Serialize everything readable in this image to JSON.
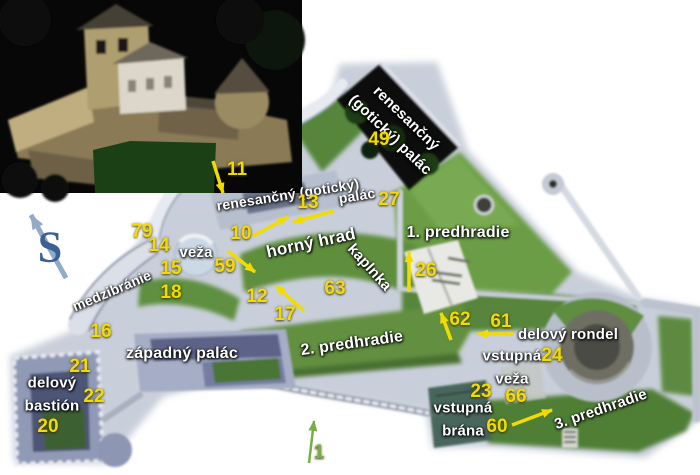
{
  "compass": {
    "letter": "S"
  },
  "colors": {
    "place_label": "#ffffff",
    "number_yellow": "#f2dc00",
    "number_green": "#76b043",
    "arrow_yellow": "#f2dc00",
    "arrow_green": "#76b043",
    "arrow_blue": "#92abca",
    "compass_letter": "#3a6094"
  },
  "map": {
    "place_labels": [
      {
        "text": "renesančný\n(gotický) palác",
        "x": 398,
        "y": 127,
        "rot": 44,
        "size": 15
      },
      {
        "text": "renesančný (gotický)",
        "x": 288,
        "y": 195,
        "rot": -9,
        "size": 14
      },
      {
        "text": "palác",
        "x": 357,
        "y": 196,
        "rot": -9,
        "size": 14
      },
      {
        "text": "horný hrad",
        "x": 311,
        "y": 243,
        "rot": -12,
        "size": 17
      },
      {
        "text": "veža",
        "x": 196,
        "y": 253,
        "rot": 0,
        "size": 15
      },
      {
        "text": "medzibránie",
        "x": 112,
        "y": 291,
        "rot": -23,
        "size": 14
      },
      {
        "text": "1. predhradie",
        "x": 458,
        "y": 233,
        "rot": 0,
        "size": 16
      },
      {
        "text": "kaplnka",
        "x": 369,
        "y": 268,
        "rot": 48,
        "size": 15
      },
      {
        "text": "2. predhradie",
        "x": 352,
        "y": 344,
        "rot": -8,
        "size": 16
      },
      {
        "text": "západný palác",
        "x": 182,
        "y": 354,
        "rot": 0,
        "size": 16
      },
      {
        "text": "delový\nbastión",
        "x": 52,
        "y": 395,
        "rot": 0,
        "size": 15
      },
      {
        "text": "delový rondel",
        "x": 568,
        "y": 335,
        "rot": 0,
        "size": 15
      },
      {
        "text": "vstupná\nveža",
        "x": 512,
        "y": 368,
        "rot": 0,
        "size": 15
      },
      {
        "text": "vstupná\nbrána",
        "x": 463,
        "y": 420,
        "rot": 0,
        "size": 15
      },
      {
        "text": "3. predhradie",
        "x": 601,
        "y": 410,
        "rot": -19,
        "size": 15
      }
    ],
    "numbers": [
      {
        "text": "11",
        "x": 237,
        "y": 170,
        "color": "yellow"
      },
      {
        "text": "49",
        "x": 379,
        "y": 140,
        "color": "yellow"
      },
      {
        "text": "13",
        "x": 308,
        "y": 203,
        "color": "yellow"
      },
      {
        "text": "27",
        "x": 389,
        "y": 200,
        "color": "yellow"
      },
      {
        "text": "79",
        "x": 142,
        "y": 232,
        "color": "yellow"
      },
      {
        "text": "14",
        "x": 159,
        "y": 246,
        "color": "yellow"
      },
      {
        "text": "10",
        "x": 241,
        "y": 234,
        "color": "yellow"
      },
      {
        "text": "15",
        "x": 171,
        "y": 269,
        "color": "yellow"
      },
      {
        "text": "59",
        "x": 225,
        "y": 267,
        "color": "yellow"
      },
      {
        "text": "18",
        "x": 171,
        "y": 293,
        "color": "yellow"
      },
      {
        "text": "12",
        "x": 257,
        "y": 297,
        "color": "yellow"
      },
      {
        "text": "17",
        "x": 285,
        "y": 315,
        "color": "yellow"
      },
      {
        "text": "63",
        "x": 335,
        "y": 289,
        "color": "yellow"
      },
      {
        "text": "26",
        "x": 426,
        "y": 271,
        "color": "yellow"
      },
      {
        "text": "16",
        "x": 101,
        "y": 332,
        "color": "yellow"
      },
      {
        "text": "21",
        "x": 80,
        "y": 367,
        "color": "yellow"
      },
      {
        "text": "22",
        "x": 94,
        "y": 397,
        "color": "yellow"
      },
      {
        "text": "20",
        "x": 48,
        "y": 427,
        "color": "yellow"
      },
      {
        "text": "62",
        "x": 460,
        "y": 320,
        "color": "yellow"
      },
      {
        "text": "61",
        "x": 501,
        "y": 322,
        "color": "yellow"
      },
      {
        "text": "24",
        "x": 552,
        "y": 356,
        "color": "yellow"
      },
      {
        "text": "23",
        "x": 481,
        "y": 392,
        "color": "yellow"
      },
      {
        "text": "66",
        "x": 516,
        "y": 397,
        "color": "yellow"
      },
      {
        "text": "60",
        "x": 497,
        "y": 427,
        "color": "yellow"
      },
      {
        "text": "1",
        "x": 319,
        "y": 453,
        "color": "green"
      }
    ],
    "arrows": [
      {
        "x1": 213,
        "y1": 161,
        "x2": 223,
        "y2": 193,
        "color": "yellow",
        "w": 3.5
      },
      {
        "x1": 253,
        "y1": 236,
        "x2": 288,
        "y2": 217,
        "color": "yellow",
        "w": 3.5
      },
      {
        "x1": 334,
        "y1": 211,
        "x2": 293,
        "y2": 222,
        "color": "yellow",
        "w": 3.5
      },
      {
        "x1": 228,
        "y1": 251,
        "x2": 255,
        "y2": 272,
        "color": "yellow",
        "w": 3.5
      },
      {
        "x1": 304,
        "y1": 311,
        "x2": 276,
        "y2": 286,
        "color": "yellow",
        "w": 3.5
      },
      {
        "x1": 409,
        "y1": 292,
        "x2": 409,
        "y2": 252,
        "color": "yellow",
        "w": 3.5
      },
      {
        "x1": 451,
        "y1": 340,
        "x2": 441,
        "y2": 313,
        "color": "yellow",
        "w": 3.5
      },
      {
        "x1": 513,
        "y1": 334,
        "x2": 478,
        "y2": 334,
        "color": "yellow",
        "w": 3.5
      },
      {
        "x1": 512,
        "y1": 425,
        "x2": 552,
        "y2": 410,
        "color": "yellow",
        "w": 3.5
      },
      {
        "x1": 309,
        "y1": 463,
        "x2": 314,
        "y2": 421,
        "color": "green",
        "w": 2.5
      },
      {
        "x1": 66,
        "y1": 278,
        "x2": 31,
        "y2": 215,
        "color": "blue",
        "w": 5
      }
    ]
  }
}
